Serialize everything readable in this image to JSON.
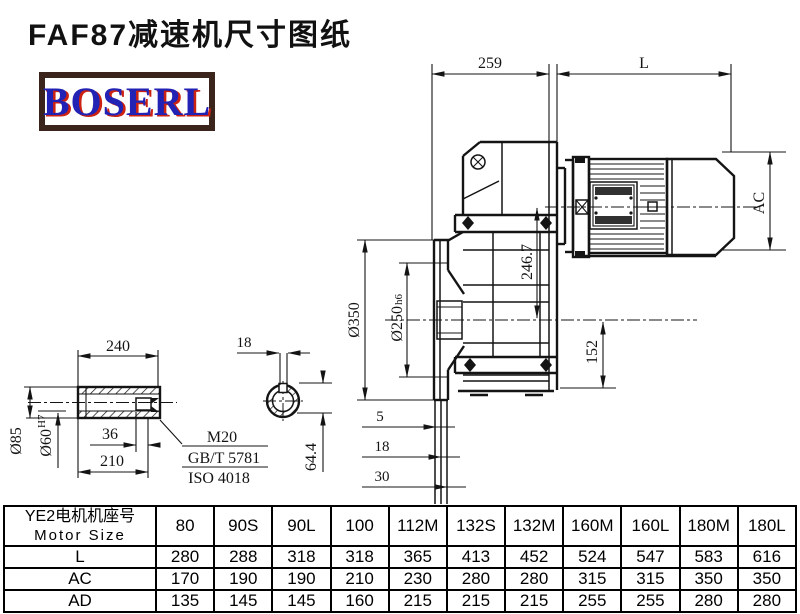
{
  "page": {
    "title": "FAF87减速机尺寸图纸"
  },
  "logo": {
    "text": "BOSERL"
  },
  "colors": {
    "line": "#141414",
    "logo_text": "#2222b4",
    "logo_shadow": "#cc2211",
    "logo_border": "#3a241c"
  },
  "drawing": {
    "dimensions": {
      "top_width": "259",
      "motor_length": "L",
      "motor_diameter": "AC",
      "axis_distance": "246.7",
      "flange_od": "Ø350",
      "spigot": "Ø250",
      "spigot_tol": "h6",
      "bottom_height": "152",
      "offset_a": "5",
      "offset_b": "18",
      "offset_c": "30",
      "shaft_length": "240",
      "keyway_width": "18",
      "shaft_od": "Ø85",
      "bore": "Ø60",
      "bore_tol": "H7",
      "thread_depth": "36",
      "bore_length": "210",
      "thread": "M20",
      "thread_std": "GB/T 5781",
      "thread_iso": "ISO 4018",
      "keyway_height": "64.4"
    }
  },
  "table": {
    "header": {
      "line1": "YE2电机机座号",
      "line2": "Motor Size"
    },
    "columns": [
      "80",
      "90S",
      "90L",
      "100",
      "112M",
      "132S",
      "132M",
      "160M",
      "160L",
      "180M",
      "180L"
    ],
    "rows": [
      {
        "label": "L",
        "values": [
          "280",
          "288",
          "318",
          "318",
          "365",
          "413",
          "452",
          "524",
          "547",
          "583",
          "616"
        ]
      },
      {
        "label": "AC",
        "values": [
          "170",
          "190",
          "190",
          "210",
          "230",
          "280",
          "280",
          "315",
          "315",
          "350",
          "350"
        ]
      },
      {
        "label": "AD",
        "values": [
          "135",
          "145",
          "145",
          "160",
          "215",
          "215",
          "215",
          "255",
          "255",
          "280",
          "280"
        ]
      }
    ]
  }
}
